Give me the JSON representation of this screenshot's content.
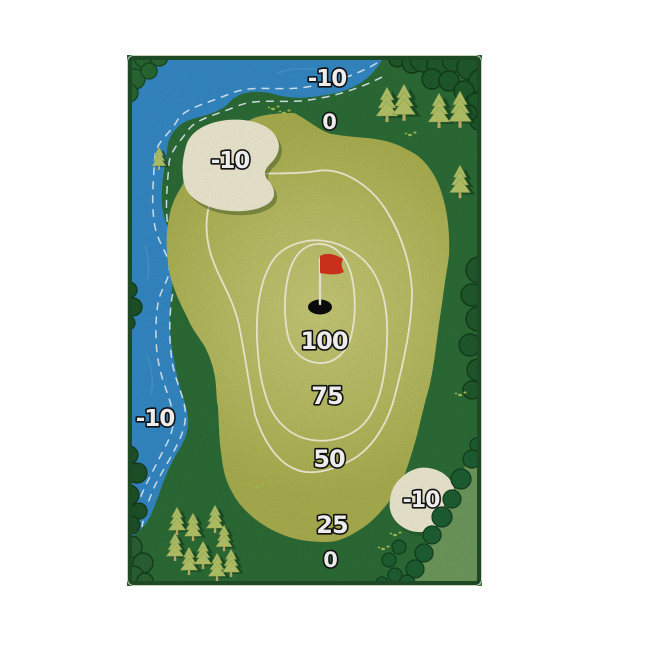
{
  "page": {
    "background": "#ffffff",
    "description": "Golf chipping game target mat with scoring zones"
  },
  "mat": {
    "border_color": "#1d4a25",
    "rough_color": "#2d6e37",
    "river_color": "#358bc9",
    "fairway_color": "#b9bd5c",
    "fairway_highlight_color": "#cbcd7a",
    "contour_color": "#f6f3dc",
    "bunker_color": "#f3eed5",
    "bush_dark_color": "#1f5c2c",
    "bush_light_color": "#6f9c5e",
    "tree_color": "#b9c86b",
    "flag_color": "#d8341f",
    "pole_color": "#eeeee0",
    "hole_color": "#0c0c0c",
    "label_fill": "#ffffff",
    "label_outline": "#131313"
  },
  "labels": {
    "river_top": "-10",
    "rough_top": "0",
    "bunker_left": "-10",
    "river_left": "-10",
    "green_100": "100",
    "ring_75": "75",
    "ring_50": "50",
    "ring_25": "25",
    "bunker_right": "-10",
    "rough_bottom": "0"
  },
  "zones": [
    {
      "name": "green-center",
      "points": "100"
    },
    {
      "name": "ring-75",
      "points": "75"
    },
    {
      "name": "ring-50",
      "points": "50"
    },
    {
      "name": "ring-25",
      "points": "25"
    },
    {
      "name": "rough",
      "points": "0"
    },
    {
      "name": "water-hazard",
      "points": "-10"
    },
    {
      "name": "sand-bunker",
      "points": "-10"
    }
  ],
  "icons": {
    "flag": "red-golf-flag",
    "hole": "golf-hole",
    "tree": "pine-tree",
    "bush": "bush",
    "water_marks": "dashed-water-line"
  }
}
